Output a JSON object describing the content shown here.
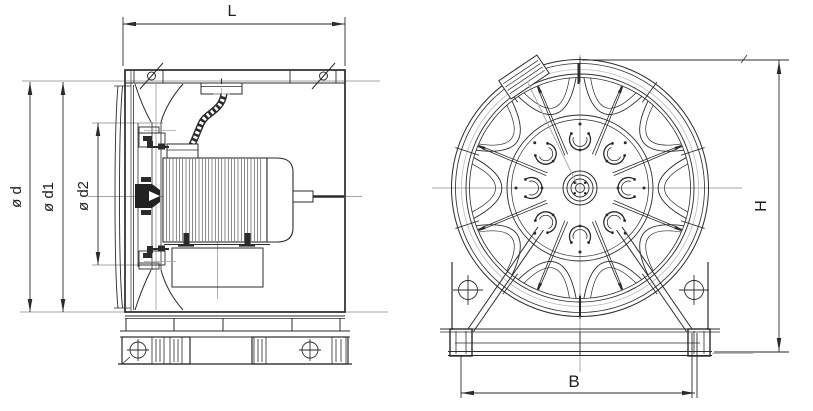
{
  "drawing": {
    "type": "technical-drawing-two-views",
    "labels": {
      "length": "L",
      "diameter_outer": "ø d",
      "diameter_mid": "ø d1",
      "diameter_inner": "ø d2",
      "height": "H",
      "width": "B"
    },
    "colors": {
      "line": "#2b2b2b",
      "centerline": "#a6a6a6",
      "background": "#ffffff"
    }
  }
}
